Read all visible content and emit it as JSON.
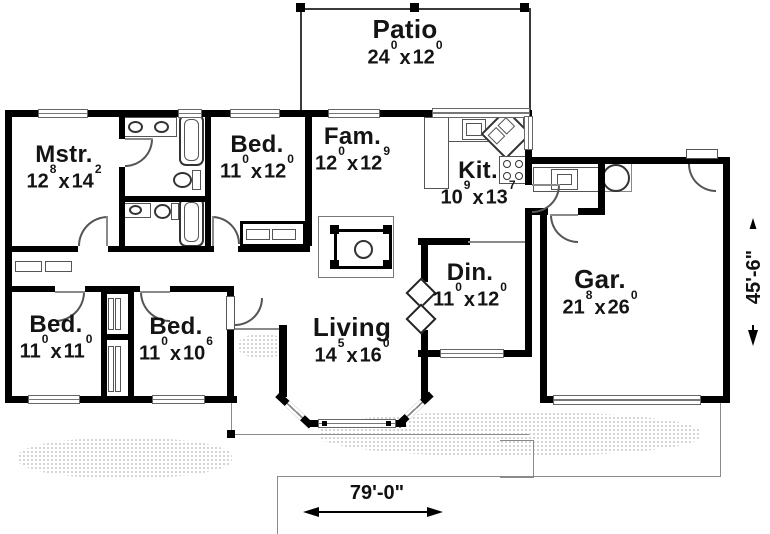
{
  "plan": {
    "sep": "x",
    "rooms": {
      "patio": {
        "name": "Patio",
        "d0": "24",
        "d1": "0",
        "d2": "12",
        "d3": "0"
      },
      "mstr": {
        "name": "Mstr.",
        "d0": "12",
        "d1": "8",
        "d2": "14",
        "d3": "2"
      },
      "bed_top": {
        "name": "Bed.",
        "d0": "11",
        "d1": "0",
        "d2": "12",
        "d3": "0"
      },
      "fam": {
        "name": "Fam.",
        "d0": "12",
        "d1": "0",
        "d2": "12",
        "d3": "9"
      },
      "kit": {
        "name": "Kit.",
        "d0": "10",
        "d1": "9",
        "d2": "13",
        "d3": "7"
      },
      "din": {
        "name": "Din.",
        "d0": "11",
        "d1": "0",
        "d2": "12",
        "d3": "0"
      },
      "living": {
        "name": "Living",
        "d0": "14",
        "d1": "5",
        "d2": "16",
        "d3": "0"
      },
      "gar": {
        "name": "Gar.",
        "d0": "21",
        "d1": "8",
        "d2": "26",
        "d3": "0"
      },
      "bed_left": {
        "name": "Bed.",
        "d0": "11",
        "d1": "0",
        "d2": "11",
        "d3": "0"
      },
      "bed_mid": {
        "name": "Bed.",
        "d0": "11",
        "d1": "0",
        "d2": "10",
        "d3": "6"
      }
    },
    "dimensions": {
      "overall_width": "79'-0\"",
      "overall_height": "45'-6\""
    },
    "drawing_colors": {
      "wall": "#000000",
      "thin_line": "#8a8a8a",
      "background": "#ffffff"
    },
    "fixtures": [
      "bathtub-icon",
      "toilet-icon",
      "sink-icon",
      "vanity-icon",
      "range-icon",
      "kitchen-sink-icon",
      "dishwasher-icon",
      "washer-icon",
      "water-heater-icon",
      "fireplace-icon",
      "wardrobe-icon",
      "closet-bifold-icon",
      "bay-window-icon",
      "garage-door-icon",
      "sliding-door-icon"
    ]
  }
}
